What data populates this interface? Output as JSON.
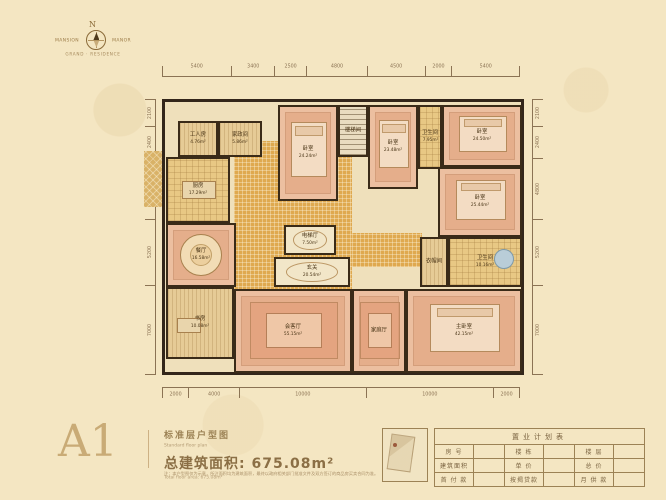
{
  "colors": {
    "background": "#f4e6c2",
    "wall": "#33261a",
    "accent": "#8b6f45",
    "gold_tile": "#dfa94f",
    "carpet": "#ecbfa0"
  },
  "logo": {
    "north": "N",
    "left_text": "MANSION",
    "right_text": "MANOR",
    "sub_text": "GRAND · RESIDENCE"
  },
  "dimensions": {
    "top": [
      "5400",
      "3400",
      "2500",
      "4800",
      "4500",
      "2000",
      "5400"
    ],
    "bottom": [
      "2000",
      "4000",
      "10000",
      "10000",
      "2000"
    ],
    "left": [
      "2100",
      "2400",
      "4800",
      "5200",
      "7000"
    ],
    "right": [
      "2100",
      "2400",
      "4800",
      "5200",
      "7000"
    ]
  },
  "floor_plan": {
    "zones": [
      {
        "key": "hall-corridor",
        "x": 96,
        "y": 56,
        "w": 118,
        "h": 150,
        "floor": "gold"
      },
      {
        "key": "wing-corridor",
        "x": 214,
        "y": 148,
        "w": 70,
        "h": 34,
        "floor": "gold"
      },
      {
        "key": "balcony-left",
        "x": 6,
        "y": 66,
        "w": 18,
        "h": 56,
        "floor": "diamond"
      },
      {
        "key": "balcony-bottom",
        "x": 282,
        "y": 278,
        "w": 98,
        "h": 10,
        "floor": "diamond"
      }
    ],
    "rooms": [
      {
        "key": "maid-room",
        "name": "工人房",
        "area": "4.76m²",
        "x": 40,
        "y": 36,
        "w": 40,
        "h": 36,
        "floor": "wood"
      },
      {
        "key": "laundry-room",
        "name": "家政间",
        "area": "5.86m²",
        "x": 80,
        "y": 36,
        "w": 44,
        "h": 36,
        "floor": "wood"
      },
      {
        "key": "kitchen",
        "name": "厨房",
        "area": "17.29m²",
        "x": 28,
        "y": 72,
        "w": 64,
        "h": 66,
        "floor": "tile",
        "furniture": "island"
      },
      {
        "key": "guest-suite",
        "name": "卧室",
        "area": "24.24m²",
        "x": 140,
        "y": 20,
        "w": 60,
        "h": 96,
        "floor": "carpet",
        "furniture": "bed"
      },
      {
        "key": "stair-well",
        "name": "楼梯间",
        "area": "",
        "x": 200,
        "y": 20,
        "w": 30,
        "h": 52,
        "floor": "stairs"
      },
      {
        "key": "bedroom-2",
        "name": "卧室",
        "area": "23.48m²",
        "x": 230,
        "y": 20,
        "w": 50,
        "h": 84,
        "floor": "carpet",
        "furniture": "bed"
      },
      {
        "key": "bath-2",
        "name": "卫生间",
        "area": "7.95m²",
        "x": 280,
        "y": 20,
        "w": 24,
        "h": 64,
        "floor": "tile"
      },
      {
        "key": "bedroom-3",
        "name": "卧室",
        "area": "24.50m²",
        "x": 304,
        "y": 20,
        "w": 80,
        "h": 62,
        "floor": "carpet",
        "furniture": "bed"
      },
      {
        "key": "bedroom-4",
        "name": "卧室",
        "area": "25.44m²",
        "x": 300,
        "y": 82,
        "w": 84,
        "h": 70,
        "floor": "carpet",
        "furniture": "bed"
      },
      {
        "key": "cloakroom",
        "name": "衣帽间",
        "area": "",
        "x": 282,
        "y": 152,
        "w": 28,
        "h": 50,
        "floor": "wood"
      },
      {
        "key": "master-bath",
        "name": "卫生间",
        "area": "10.16m²",
        "x": 310,
        "y": 152,
        "w": 74,
        "h": 50,
        "floor": "tile",
        "furniture": "tub"
      },
      {
        "key": "dining-room",
        "name": "餐厅",
        "area": "16.58m²",
        "x": 28,
        "y": 138,
        "w": 70,
        "h": 64,
        "floor": "carpet",
        "furniture": "round-table"
      },
      {
        "key": "study",
        "name": "书房",
        "area": "10.08m²",
        "x": 28,
        "y": 202,
        "w": 68,
        "h": 72,
        "floor": "wood",
        "furniture": "desk"
      },
      {
        "key": "elevator-hall",
        "name": "电梯厅",
        "area": "7.50m²",
        "x": 146,
        "y": 140,
        "w": 52,
        "h": 30,
        "floor": "marble",
        "furniture": "oval"
      },
      {
        "key": "foyer",
        "name": "玄关",
        "area": "20.54m²",
        "x": 136,
        "y": 172,
        "w": 76,
        "h": 30,
        "floor": "marble",
        "furniture": "oval"
      },
      {
        "key": "living-room",
        "name": "会客厅",
        "area": "55.15m²",
        "x": 96,
        "y": 204,
        "w": 118,
        "h": 84,
        "floor": "carpet",
        "furniture": "sofa"
      },
      {
        "key": "family-room",
        "name": "家庭厅",
        "area": "",
        "x": 214,
        "y": 204,
        "w": 54,
        "h": 84,
        "floor": "carpet",
        "furniture": "sofa"
      },
      {
        "key": "master-bedroom",
        "name": "主卧室",
        "area": "42.15m²",
        "x": 268,
        "y": 204,
        "w": 116,
        "h": 84,
        "floor": "carpet",
        "furniture": "bed"
      }
    ]
  },
  "title_block": {
    "unit": "A1",
    "name_cn": "标准层户型图",
    "name_en": "Standard floor plan",
    "area_label": "总建筑面积: 675.08m²",
    "area_en": "Total floor area: 675.08m²",
    "disclaimer": "注：本户型图仅为示意，所注面积均为建筑面积，最终以政府相关部门批准文件及双方签订的商品房买卖合同为准。"
  },
  "plan_table": {
    "title": "置业计划表",
    "rows": [
      [
        "房  号",
        "楼  栋",
        "楼  层"
      ],
      [
        "建筑面积",
        "单  价",
        "总  价"
      ],
      [
        "首 付 款",
        "按揭贷款",
        "月 供 款"
      ]
    ]
  }
}
